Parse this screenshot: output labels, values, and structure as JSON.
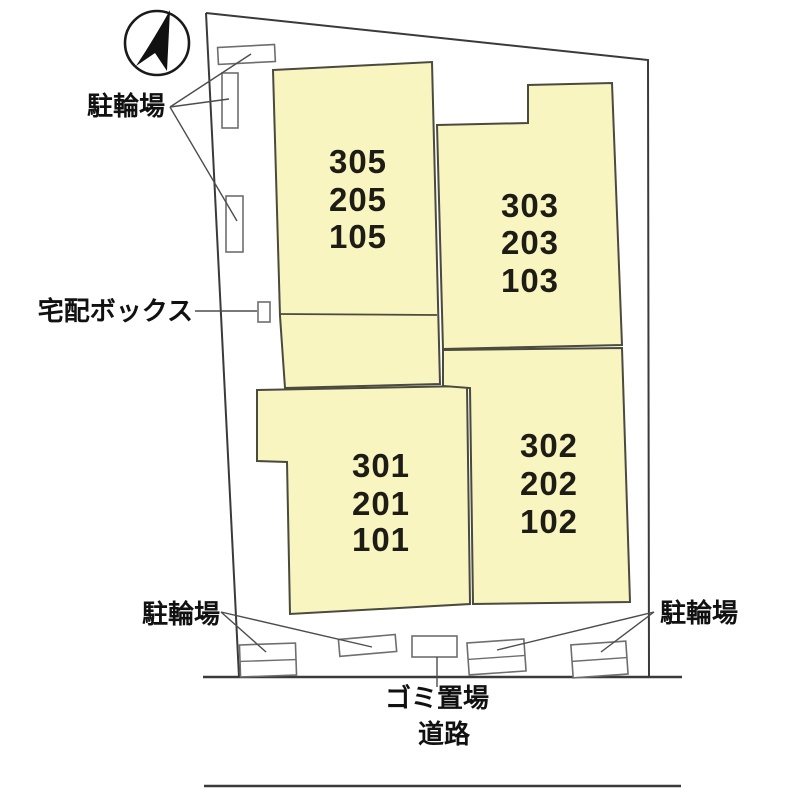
{
  "plan": {
    "title_hint": "apartment site plan",
    "buildings": [
      {
        "name": "building-west",
        "units": [
          "305",
          "205",
          "105"
        ]
      },
      {
        "name": "building-east",
        "units": [
          "303",
          "203",
          "103"
        ]
      },
      {
        "name": "building-southwest",
        "units": [
          "301",
          "201",
          "101"
        ]
      },
      {
        "name": "building-southeast",
        "units": [
          "302",
          "202",
          "102"
        ]
      }
    ],
    "labels": {
      "bicycle_parking_top": "駐輪場",
      "delivery_box": "宅配ボックス",
      "bicycle_parking_bottom_left": "駐輪場",
      "garbage_area": "ゴミ置場",
      "road": "道路",
      "bicycle_parking_bottom_right": "駐輪場"
    },
    "icons": {
      "compass": "north-arrow-icon"
    },
    "colors": {
      "building_fill": "#f9f5c0",
      "building_stroke": "#4a4a3e",
      "boundary_stroke": "#3a3a3a",
      "parking_stroke": "#6e6e6e",
      "text_color": "#1d1d16"
    }
  }
}
